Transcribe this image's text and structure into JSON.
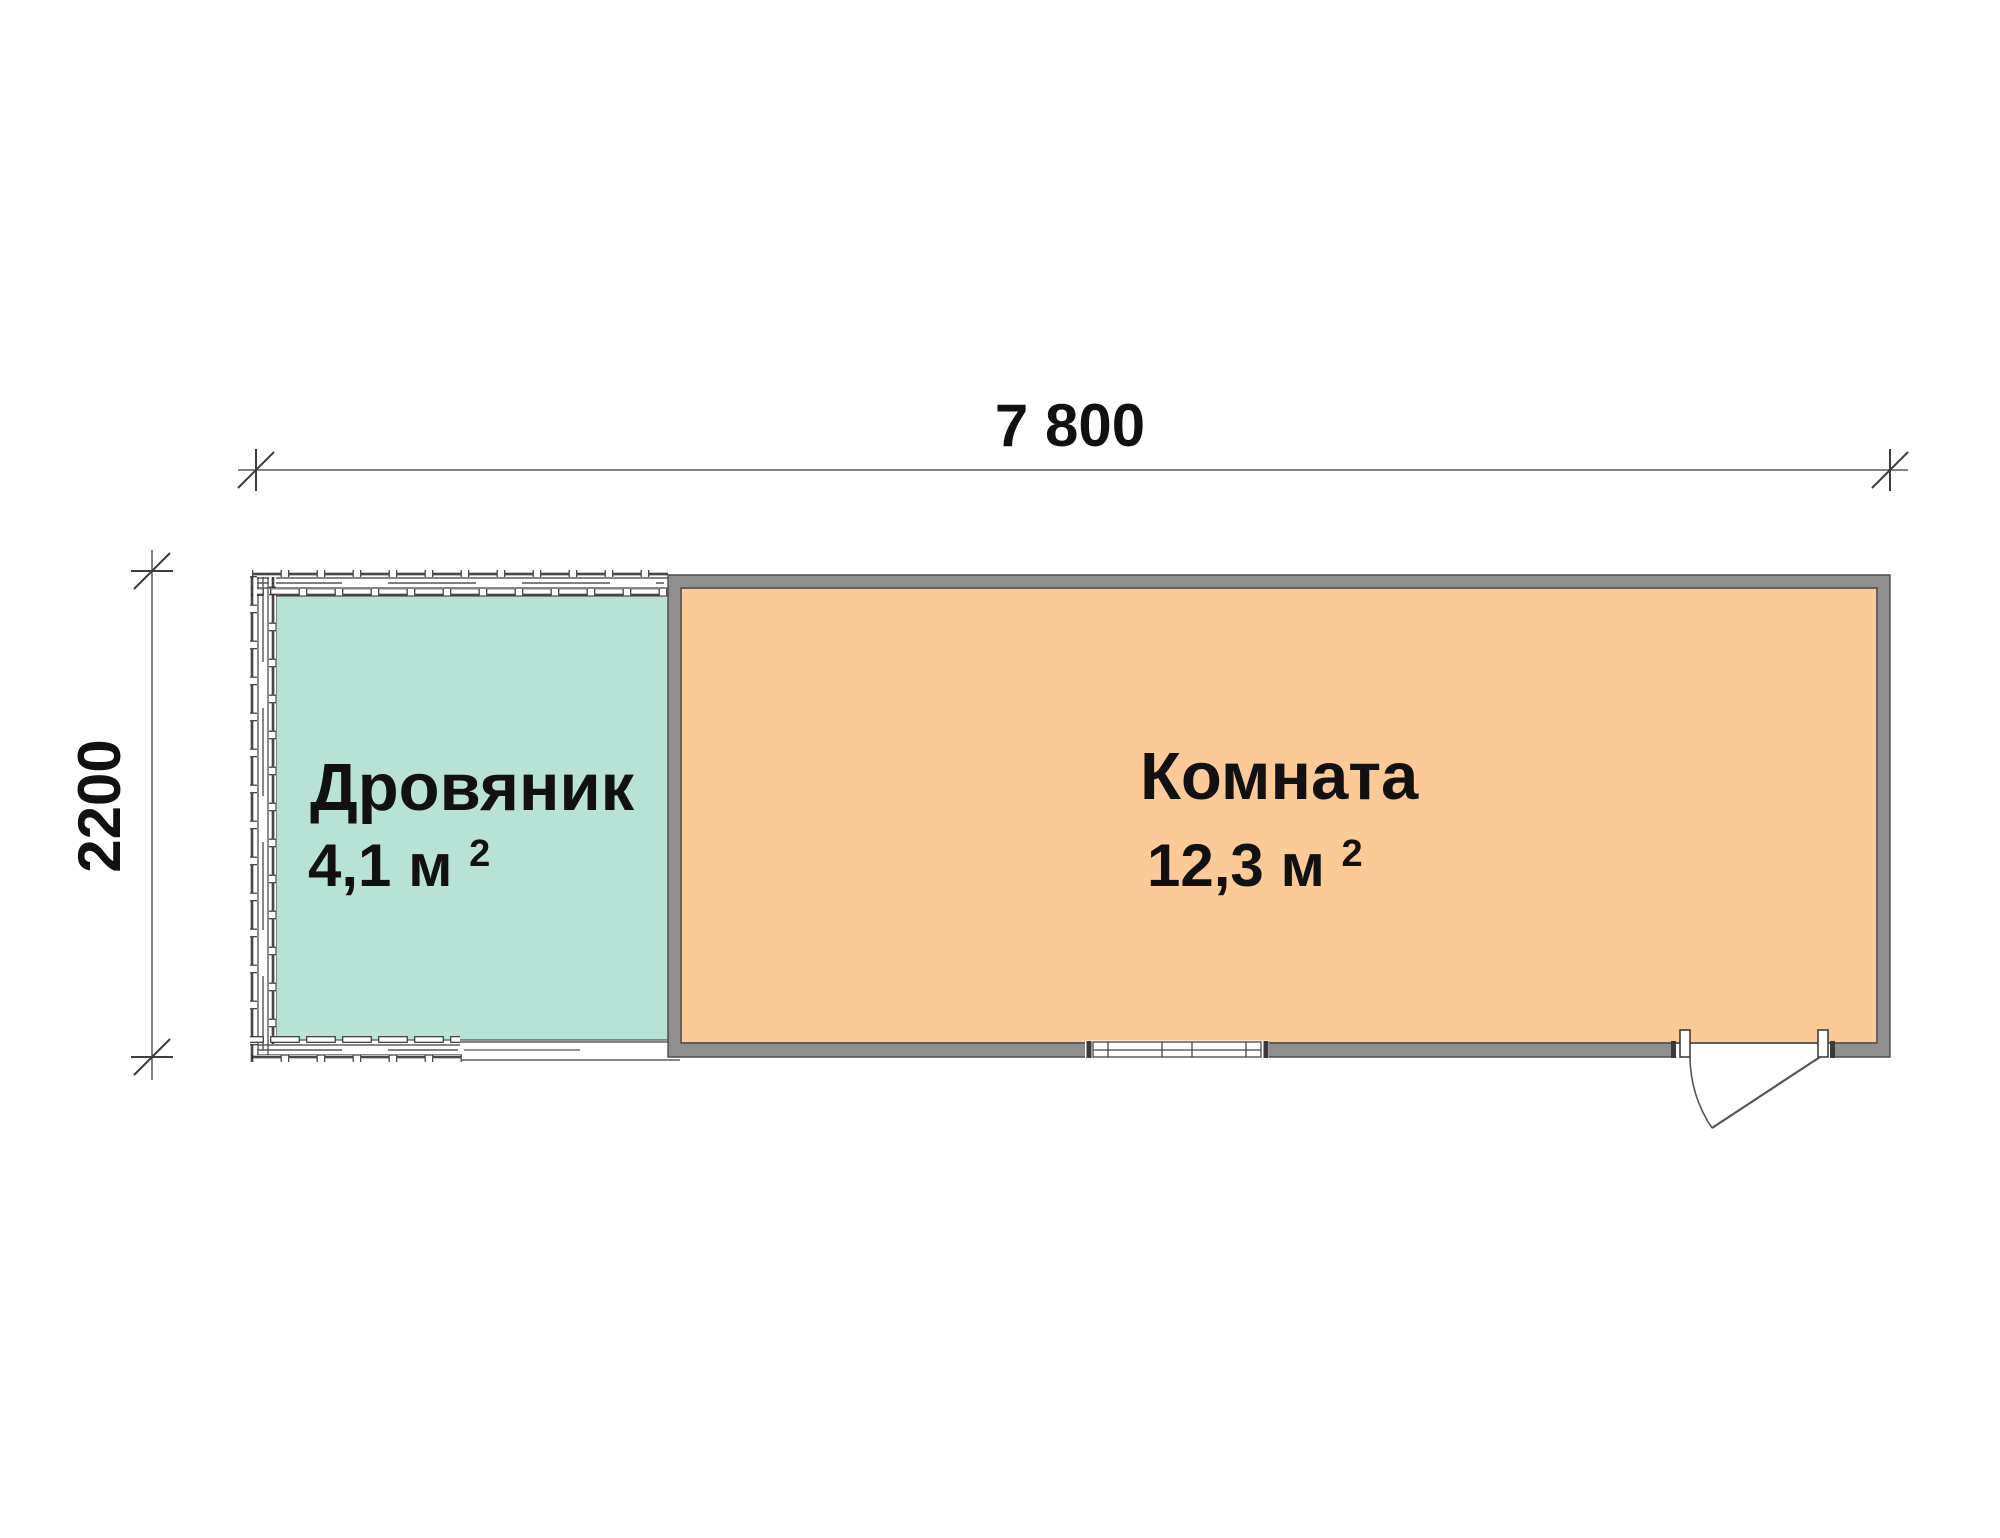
{
  "plan": {
    "top_dimension": {
      "label": "7 800"
    },
    "left_dimension": {
      "label": "2200"
    },
    "rooms": [
      {
        "name": "Дровяник",
        "area": "4,1 м",
        "area_superscript": "2",
        "fill": "#b7e2d5"
      },
      {
        "name": "Комната",
        "area": "12,3 м",
        "area_superscript": "2",
        "fill": "#fbca96"
      }
    ],
    "wall_color": "#8f8f8f"
  }
}
